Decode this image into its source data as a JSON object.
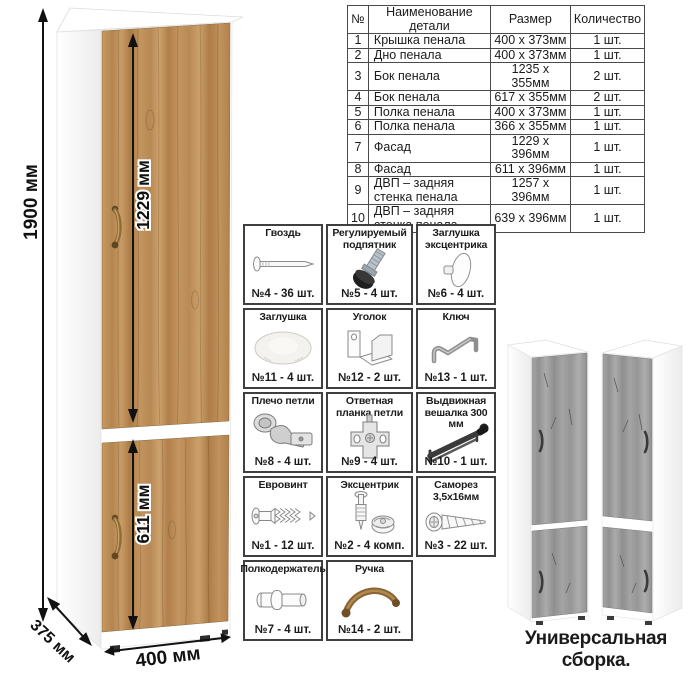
{
  "dimensions": {
    "total_height": "1900 мм",
    "top_door_height": "1229 мм",
    "bottom_door_height": "611 мм",
    "width": "400 мм",
    "depth": "375 мм"
  },
  "parts_table": {
    "headers": [
      "№",
      "Наименование детали",
      "Размер",
      "Количество"
    ],
    "rows": [
      [
        "1",
        "Крышка пенала",
        "400 x 373мм",
        "1 шт."
      ],
      [
        "2",
        "Дно пенала",
        "400 x 373мм",
        "1 шт."
      ],
      [
        "3",
        "Бок пенала",
        "1235 x 355мм",
        "2 шт."
      ],
      [
        "4",
        "Бок пенала",
        "617 x 355мм",
        "2 шт."
      ],
      [
        "5",
        "Полка пенала",
        "400 x 373мм",
        "1 шт."
      ],
      [
        "6",
        "Полка пенала",
        "366 x 355мм",
        "1 шт."
      ],
      [
        "7",
        "Фасад",
        "1229 x 396мм",
        "1 шт."
      ],
      [
        "8",
        "Фасад",
        "611 x 396мм",
        "1 шт."
      ],
      [
        "9",
        "ДВП – задняя стенка пенала",
        "1257 x 396мм",
        "1 шт."
      ],
      [
        "10",
        "ДВП – задняя стенка пенала",
        "639 x 396мм",
        "1 шт."
      ]
    ]
  },
  "hardware": {
    "items": [
      {
        "name": "Гвоздь",
        "icon": "nail-icon",
        "qty": "№4 - 36 шт."
      },
      {
        "name": "Регулируемый подпятник",
        "icon": "adjustable-foot-icon",
        "qty": "№5 - 4 шт."
      },
      {
        "name": "Заглушка эксцентрика",
        "icon": "cam-cap-icon",
        "qty": "№6 - 4 шт."
      },
      {
        "name": "Заглушка",
        "icon": "cover-cap-icon",
        "qty": "№11 - 4 шт."
      },
      {
        "name": "Уголок",
        "icon": "corner-bracket-icon",
        "qty": "№12 - 2 шт."
      },
      {
        "name": "Ключ",
        "icon": "hex-key-icon",
        "qty": "№13 - 1 шт."
      },
      {
        "name": "Плечо петли",
        "icon": "hinge-arm-icon",
        "qty": "№8 - 4 шт."
      },
      {
        "name": "Ответная планка петли",
        "icon": "hinge-plate-icon",
        "qty": "№9 - 4 шт."
      },
      {
        "name": "Выдвижная вешалка 300 мм",
        "icon": "pullout-rail-icon",
        "qty": "№10 - 1 шт."
      },
      {
        "name": "Евровинт",
        "icon": "confirmat-screw-icon",
        "qty": "№1 - 12 шт."
      },
      {
        "name": "Эксцентрик",
        "icon": "cam-lock-icon",
        "qty": "№2 - 4 комп."
      },
      {
        "name": "Саморез 3,5х16мм",
        "icon": "self-tapping-screw-icon",
        "qty": "№3 - 22 шт."
      },
      {
        "name": "Полкодержатель",
        "icon": "shelf-pin-icon",
        "qty": "№7 - 4 шт."
      },
      {
        "name": "Ручка",
        "icon": "handle-icon",
        "qty": "№14 - 2 шт."
      }
    ]
  },
  "footer": {
    "caption": "Универсальная сборка."
  },
  "colors": {
    "wood_oak": "#b9895a",
    "wood_gray": "#9d9d9d",
    "handle_bronze": "#8b6d3c",
    "dimension_ink": "#111111",
    "table_border": "#4a4a4a"
  }
}
